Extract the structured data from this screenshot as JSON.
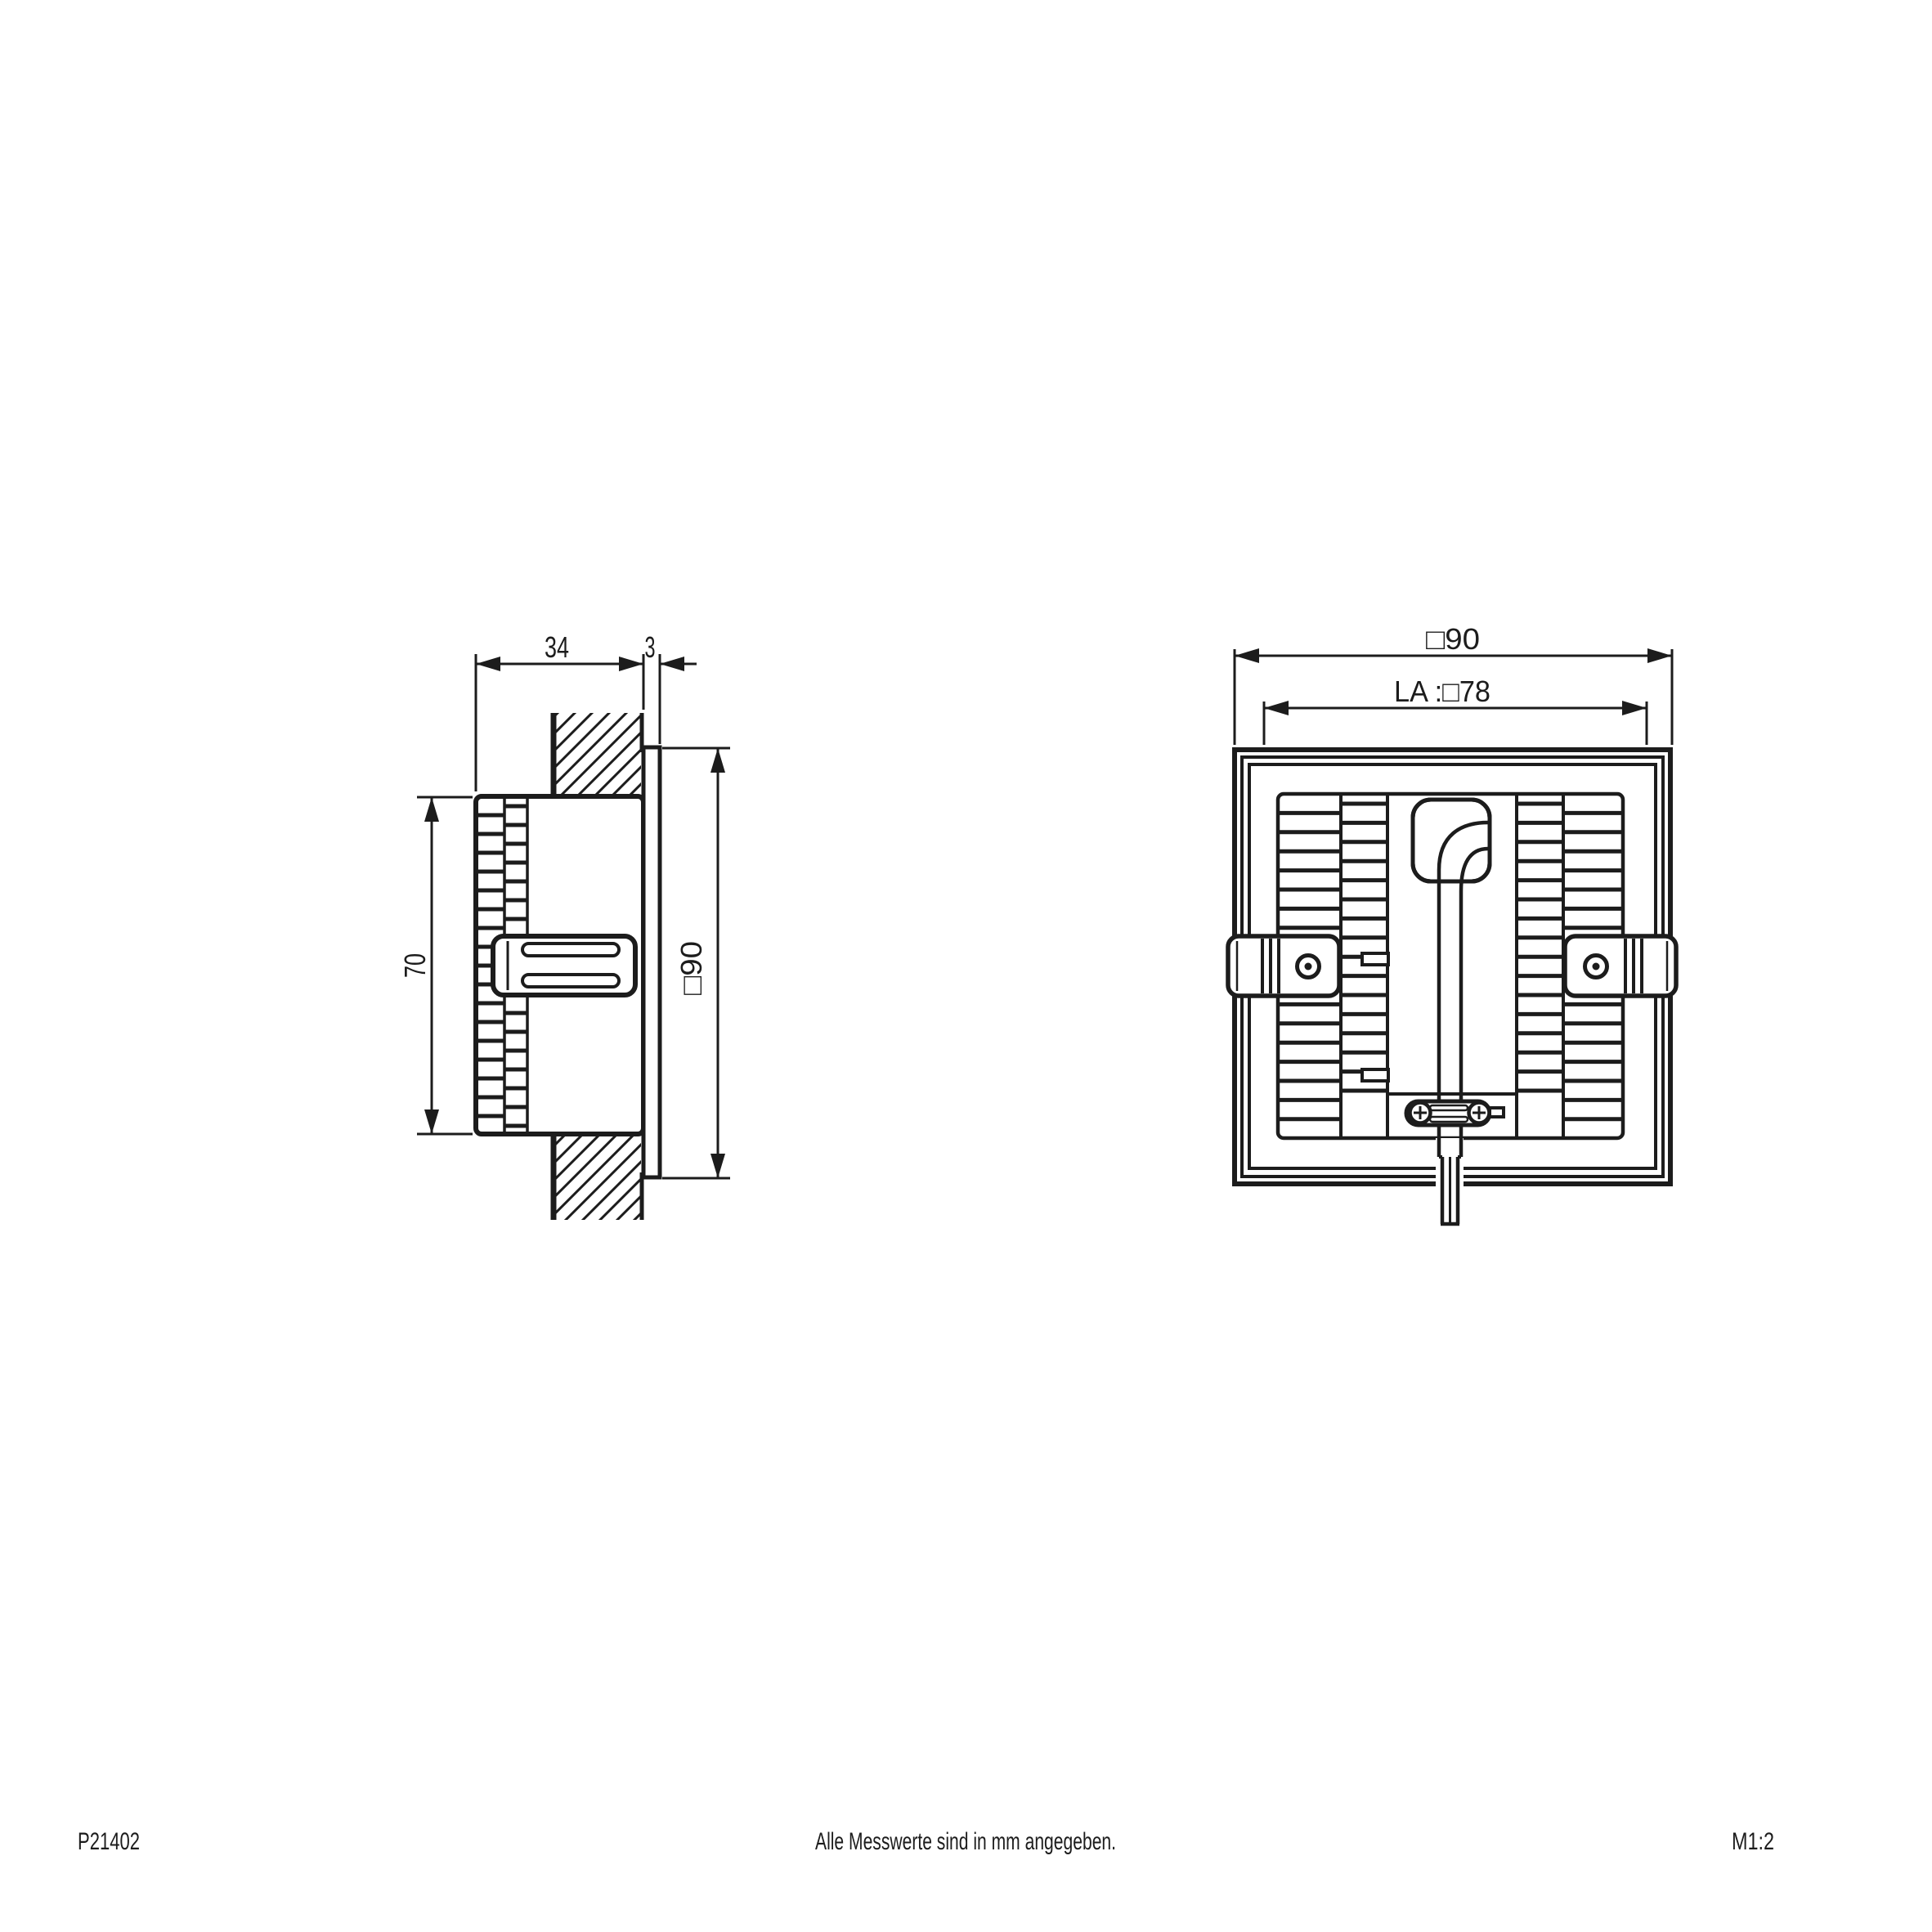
{
  "colors": {
    "line": "#1c1c1c",
    "background": "#ffffff"
  },
  "side_view": {
    "dim_depth": "34",
    "dim_frame": "3",
    "dim_height": "70",
    "dim_size": "□90"
  },
  "rear_view": {
    "dim_size": "□90",
    "dim_cutout": "LA :□78"
  },
  "footer": {
    "drawing_number": "P21402",
    "note": "Alle Messwerte sind in mm angegeben.",
    "scale": "M1:2"
  }
}
